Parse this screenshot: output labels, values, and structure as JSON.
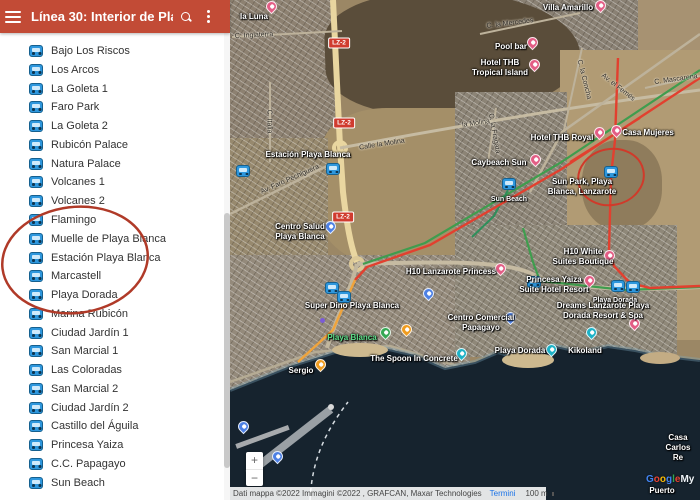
{
  "header": {
    "title": "Línea 30: Interior de Playa...",
    "menu_icon": "hamburger-menu",
    "search_icon": "magnifier",
    "overflow_icon": "three-dot-menu"
  },
  "sidebar": {
    "stops": [
      "Bajo Los Riscos",
      "Los Arcos",
      "La Goleta 1",
      "Faro Park",
      "La Goleta 2",
      "Rubicón Palace",
      "Natura Palace",
      "Volcanes 1",
      "Volcanes 2",
      "Flamingo",
      "Muelle de Playa Blanca",
      "Estación Playa Blanca",
      "Marcastell",
      "Playa Dorada",
      "Marina Rubicón",
      "Ciudad Jardín 1",
      "San Marcial 1",
      "Las Coloradas",
      "San Marcial 2",
      "Ciudad Jardín 2",
      "Castillo del Águila",
      "Princesa Yaiza",
      "C.C. Papagayo",
      "Sun Beach"
    ]
  },
  "map": {
    "labels": [
      {
        "id": "la-luna",
        "text": "la Luna"
      },
      {
        "id": "villa-amarillo",
        "text": "Villa Amarillo"
      },
      {
        "id": "pool-bar",
        "text": "Pool bar"
      },
      {
        "id": "hotel-thb-tropical",
        "text": "Hotel THB\nTropical Island"
      },
      {
        "id": "hotel-thb-royal",
        "text": "Hotel THB Royal"
      },
      {
        "id": "casa-mujeres",
        "text": "Casa Mujeres"
      },
      {
        "id": "caybeach-sun",
        "text": "Caybeach Sun"
      },
      {
        "id": "sun-park",
        "text": "Sun Park, Playa\nBlanca, Lanzarote"
      },
      {
        "id": "sun-beach",
        "text": "Sun Beach"
      },
      {
        "id": "estacion-playa-blanca",
        "text": "Estación Playa Blanca"
      },
      {
        "id": "centro-salud",
        "text": "Centro Salud\nPlaya Blanca"
      },
      {
        "id": "h10-lanzarote-princess",
        "text": "H10 Lanzarote Princess"
      },
      {
        "id": "h10-white-suites",
        "text": "H10 White\nSuites Boutique"
      },
      {
        "id": "princesa-yaiza",
        "text": "Princesa Yaiza\nSuite Hotel Resort"
      },
      {
        "id": "super-dino",
        "text": "Super Dino Playa Blanca"
      },
      {
        "id": "playa-dorada-stop",
        "text": "Playa Dorada"
      },
      {
        "id": "dreams-lanzarote",
        "text": "Dreams Lanzarote Playa\nDorada Resort & Spa"
      },
      {
        "id": "centro-comercial-papagayo",
        "text": "Centro Comercial\nPapagayo"
      },
      {
        "id": "playa-dorada-beach",
        "text": "Playa Dorada"
      },
      {
        "id": "kikoland",
        "text": "Kikoland"
      },
      {
        "id": "playa-blanca-beach",
        "text": "Playa Blanca"
      },
      {
        "id": "the-spoon",
        "text": "The Spoon In Concrete"
      },
      {
        "id": "sergio",
        "text": "Sergio"
      },
      {
        "id": "casa-carlos",
        "text": "Casa Carlos Re"
      },
      {
        "id": "puerto",
        "text": "Puerto"
      }
    ],
    "streets": [
      {
        "id": "c-inglaterra",
        "text": "C. Inglaterra"
      },
      {
        "id": "c-italia",
        "text": "C. Italia"
      },
      {
        "id": "calle-la-molina",
        "text": "Calle la Molina"
      },
      {
        "id": "la-molina",
        "text": "la Molina"
      },
      {
        "id": "av-faro-pechiguera",
        "text": "Av. Faro Pechiguera"
      },
      {
        "id": "c-la-mercedes",
        "text": "C. la Mercedes"
      },
      {
        "id": "c-la-concha",
        "text": "C. la Concha"
      },
      {
        "id": "av-el-femes",
        "text": "Av. el Femés"
      },
      {
        "id": "c-mascarena",
        "text": "C. Mascarena"
      },
      {
        "id": "c-la-fragata",
        "text": "C. la Fragata"
      }
    ],
    "road_badges": [
      "LZ-2",
      "LZ-2",
      "LZ-2"
    ],
    "zoom_in": "+",
    "zoom_out": "−",
    "attribution": {
      "text": "Dati mappa ©2022 Immagini ©2022 , GRAFCAN, Maxar Technologies",
      "terms": "Termini",
      "scale": "100 m"
    },
    "watermark": {
      "l1": "G",
      "l2": "o",
      "l3": "o",
      "l4": "g",
      "l5": "l",
      "l6": "e",
      "suffix": "My"
    }
  },
  "colors": {
    "header_red": "#c24b36",
    "annotation_red": "#b03a28",
    "route_red": "#e2402f",
    "route_green": "#3f9d4e",
    "route_orange": "#f0a43c",
    "bus_blue": "#2e97dd",
    "pin_pink": "#e35d85",
    "pin_orange": "#f09c1e",
    "pin_green": "#34a853",
    "pin_teal": "#1cb2c7",
    "pin_blue": "#4d80e4",
    "ocean": "#16232e"
  }
}
